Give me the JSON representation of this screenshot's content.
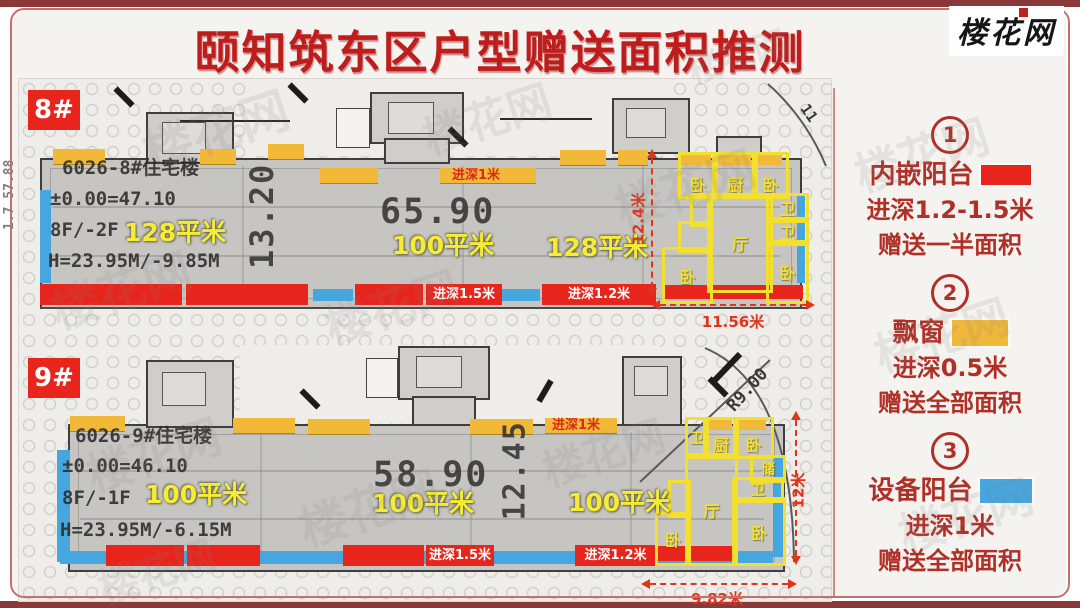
{
  "page": {
    "title": "颐知筑东区户型赠送面积推测",
    "logo": "楼花网",
    "watermark": "楼花网"
  },
  "legend": {
    "items": [
      {
        "num": "1",
        "name": "内嵌阳台",
        "depth": "进深1.2-1.5米",
        "gift": "赠送一半面积",
        "color": "#e8251d"
      },
      {
        "num": "2",
        "name": "飘窗",
        "depth": "进深0.5米",
        "gift": "赠送全部面积",
        "color": "#f0b93a"
      },
      {
        "num": "3",
        "name": "设备阳台",
        "depth": "进深1米",
        "gift": "赠送全部面积",
        "color": "#45a7de"
      }
    ]
  },
  "plan8": {
    "label": "8#",
    "name": "6026-8#住宅楼",
    "elevation": "±0.00=47.10",
    "floors": "8F/-2F",
    "height": "H=23.95M/-9.85M",
    "area_left": "128平米",
    "area_mid": "100平米",
    "area_right": "128平米",
    "dim_width": "65.90",
    "dim_depth": "13.20",
    "unit_depth": "12.4米",
    "unit_width": "11.56米",
    "bay_label": "进深1米",
    "balcony15": "进深1.5米",
    "balcony12": "进深1.2米",
    "side_note": "1.7 57.88",
    "road_note": "11",
    "rooms": {
      "bed_tl": "卧",
      "kitchen": "厨",
      "bed_tr": "卧",
      "bath1": "卫",
      "bath2": "卫",
      "hall": "厅",
      "bed_bl": "卧",
      "bed_br": "卧"
    }
  },
  "plan9": {
    "label": "9#",
    "name": "6026-9#住宅楼",
    "elevation": "±0.00=46.10",
    "floors": "8F/-1F",
    "height": "H=23.95M/-6.15M",
    "area_left": "100平米",
    "area_mid": "100平米",
    "area_right": "100平米",
    "dim_width": "58.90",
    "dim_depth": "12.45",
    "unit_depth": "12米",
    "unit_width": "9.82米",
    "radius": "R9.00",
    "bay_label": "进深1米",
    "balcony15": "进深1.5米",
    "balcony12": "进深1.2米",
    "rooms": {
      "bath_t": "卫",
      "kitchen": "厨",
      "bed_tr": "卧",
      "storage": "储",
      "bath_m": "卫",
      "hall": "厅",
      "bed_bl": "卧",
      "bed_br": "卧"
    }
  },
  "colors": {
    "balcony_red": "#e8251d",
    "bay_yellow": "#f0b93a",
    "equip_blue": "#45a7de",
    "title_red": "#bf1d1c",
    "frame_red": "#8d3838"
  }
}
